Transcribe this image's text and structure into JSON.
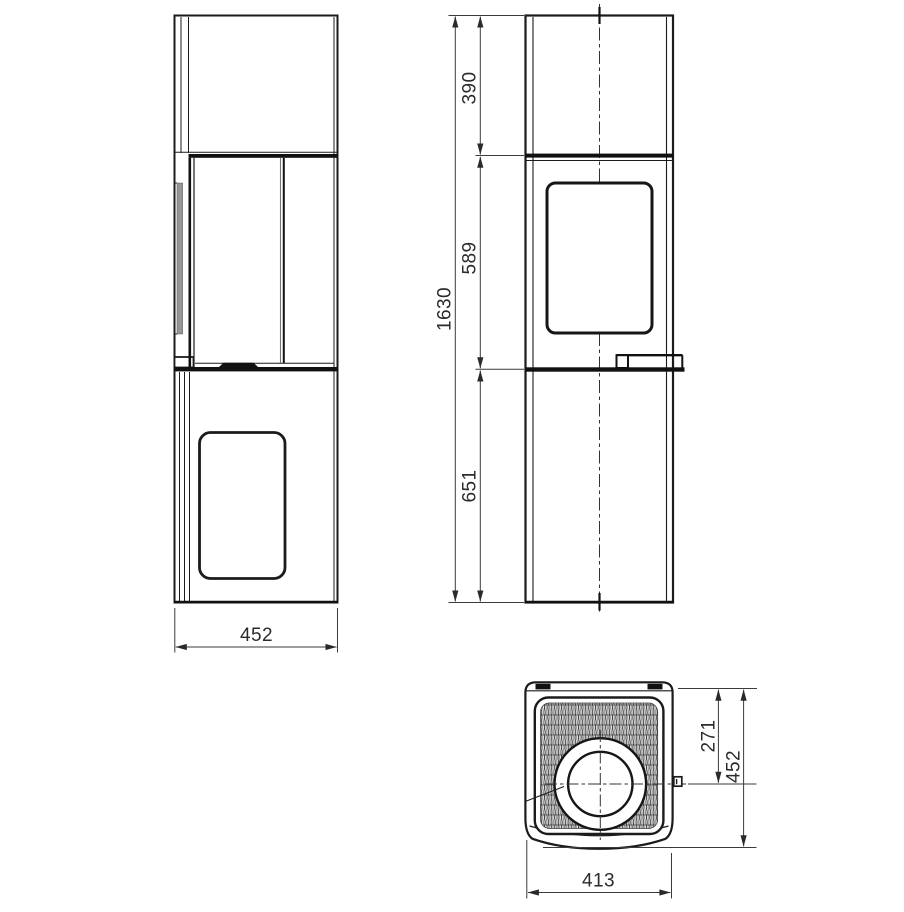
{
  "drawing": {
    "type": "technical-dimension-drawing",
    "views": [
      "side-view",
      "front-view",
      "top-view"
    ],
    "colors": {
      "outline": "#1b1b1b",
      "thin_line": "#3a3a3a",
      "glass_edge_gray": "#969696",
      "background": "#ffffff"
    },
    "dims": {
      "total_height": "1630",
      "top_section": "390",
      "firebox_section": "589",
      "base_section": "651",
      "depth_side": "452",
      "flue_offset": "271",
      "depth_top": "452",
      "width_top": "413"
    }
  }
}
